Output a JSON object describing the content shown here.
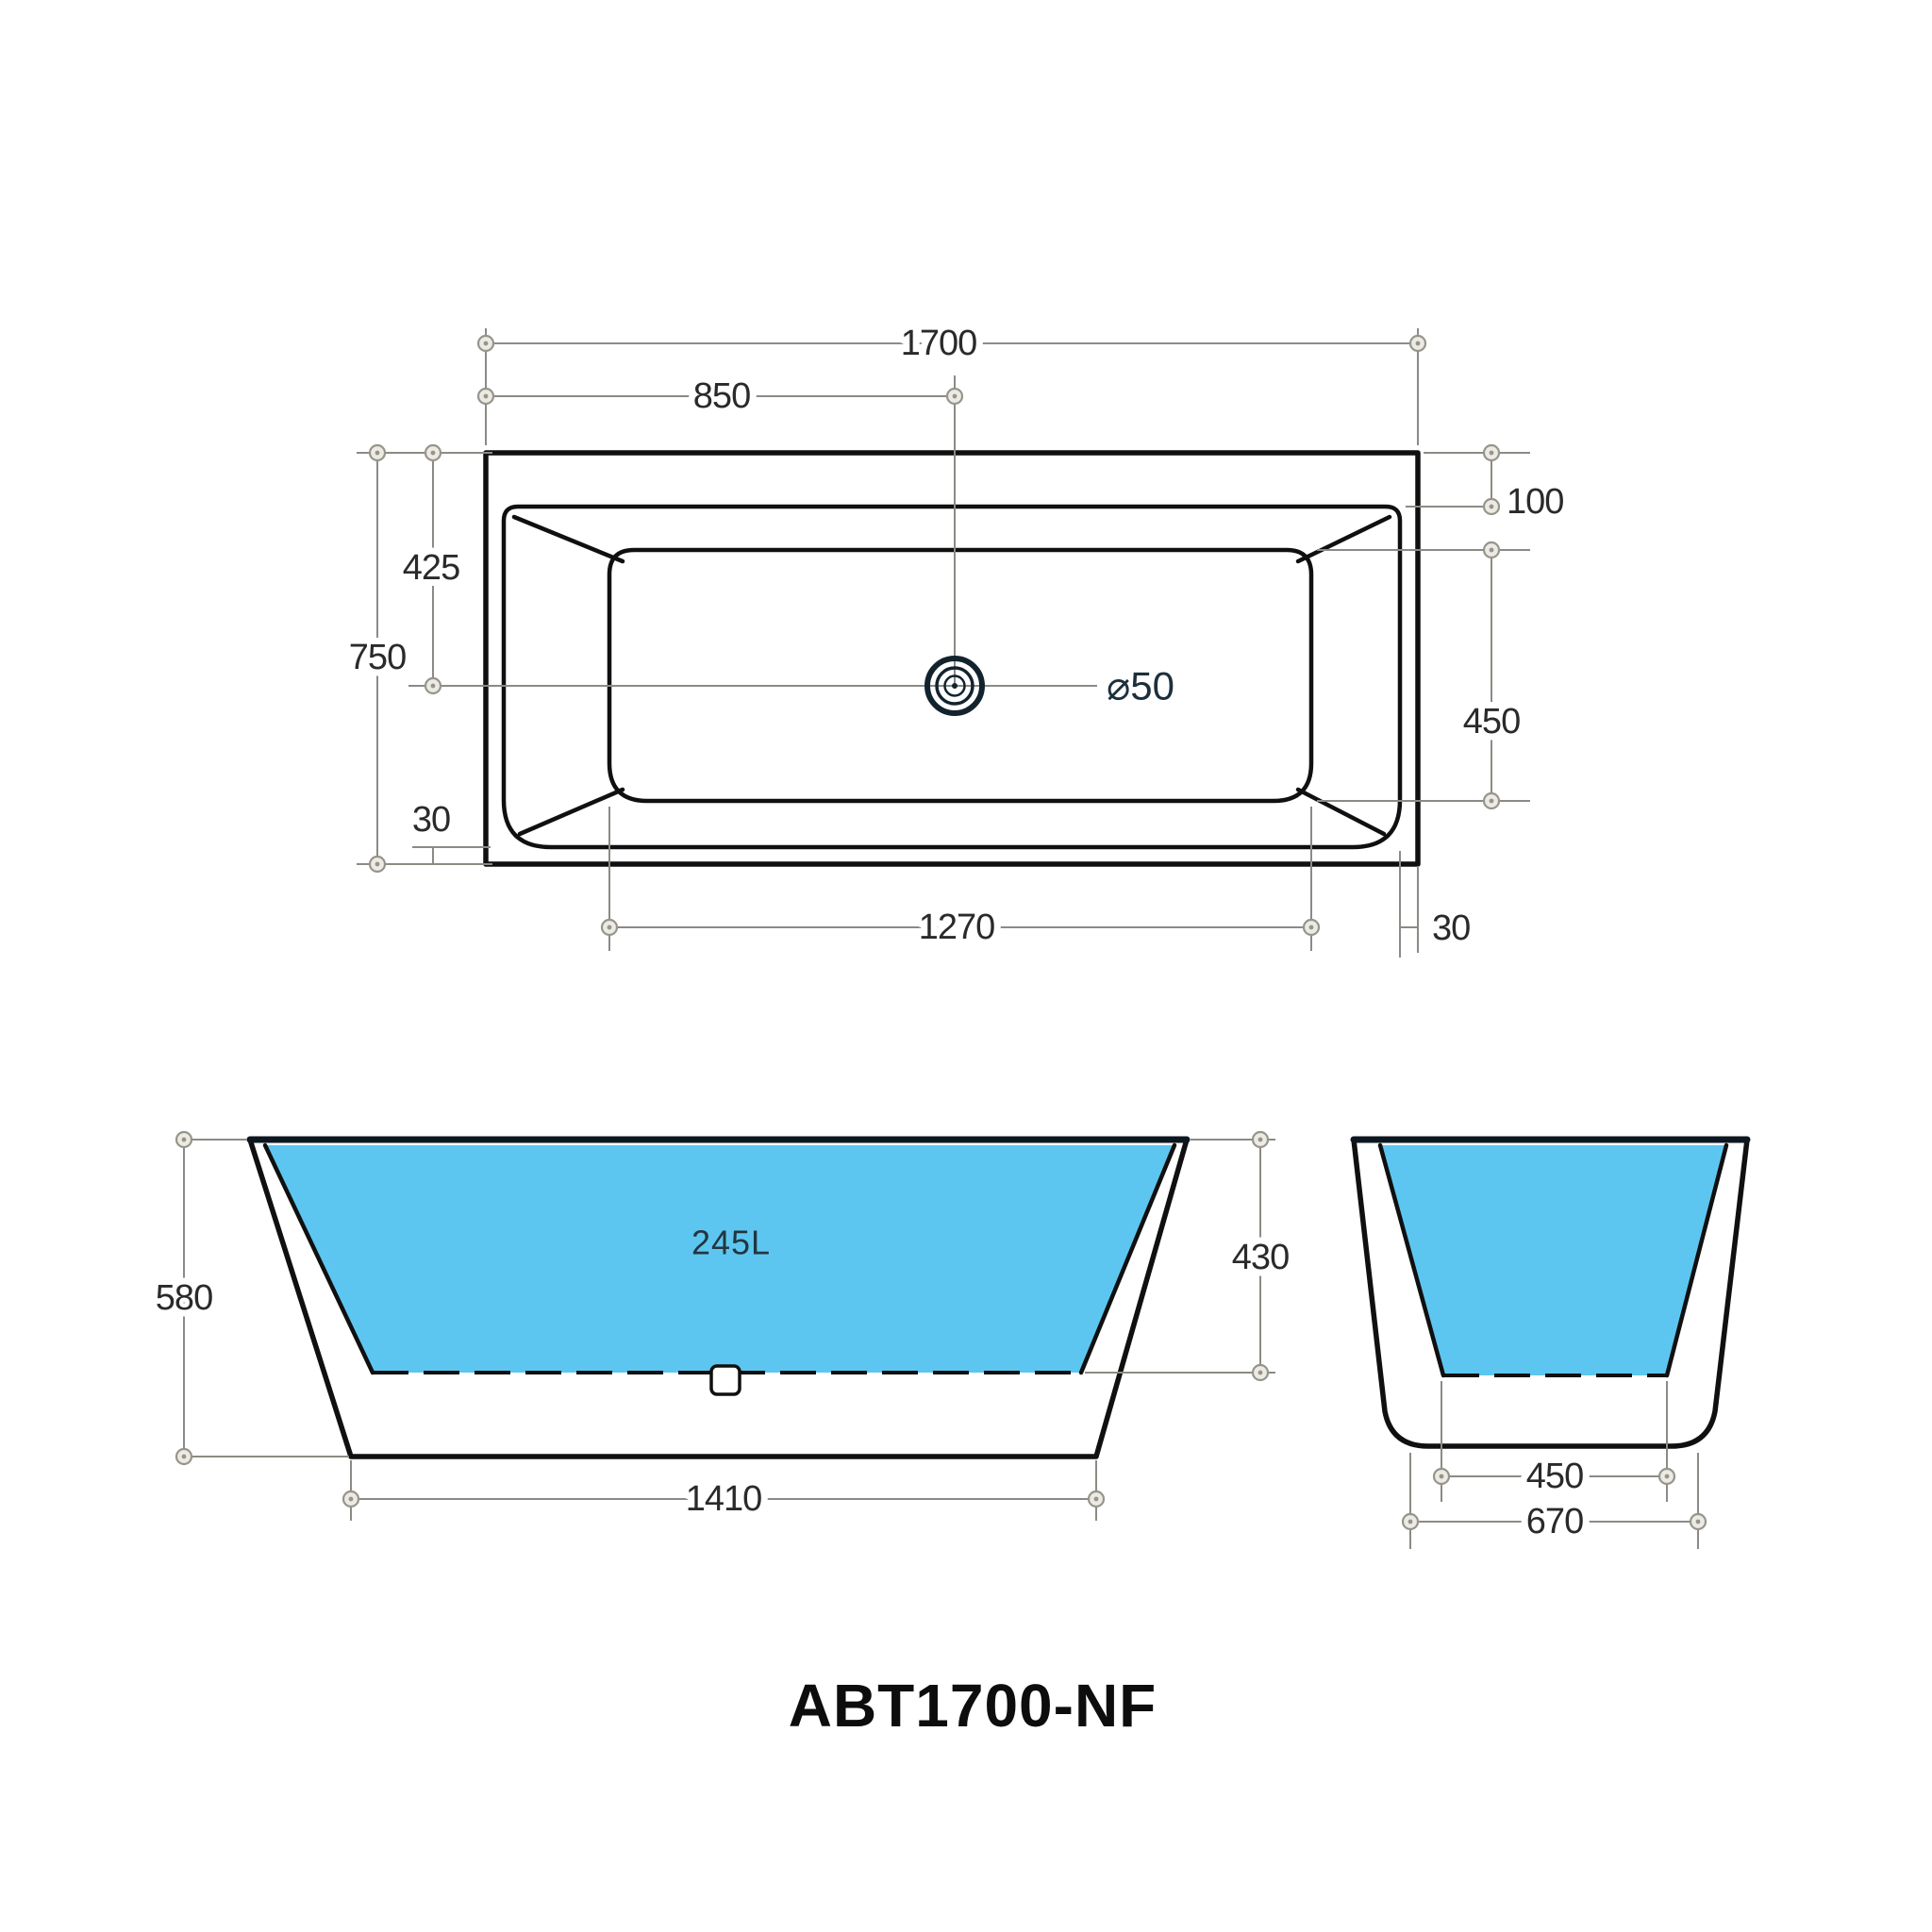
{
  "title": "ABT1700-NF",
  "colors": {
    "water": "#5dc6f0",
    "outline": "#101010",
    "dimension_gray": "#8b8b85",
    "text": "#2a2a2a"
  },
  "plan_view": {
    "dims": {
      "overall_length": "1700",
      "drain_offset": "850",
      "rim_top_width": "100",
      "drain_from_top": "425",
      "overall_width": "750",
      "floor_width": "450",
      "rim_bottom_width": "30",
      "floor_length": "1270",
      "rim_side_width": "30",
      "drain_diameter": "⌀50"
    }
  },
  "front_view": {
    "dims": {
      "overall_height": "580",
      "capacity": "245L",
      "inner_depth": "430",
      "base_length": "1410"
    }
  },
  "side_view": {
    "dims": {
      "floor_width": "450",
      "base_width": "670"
    }
  }
}
